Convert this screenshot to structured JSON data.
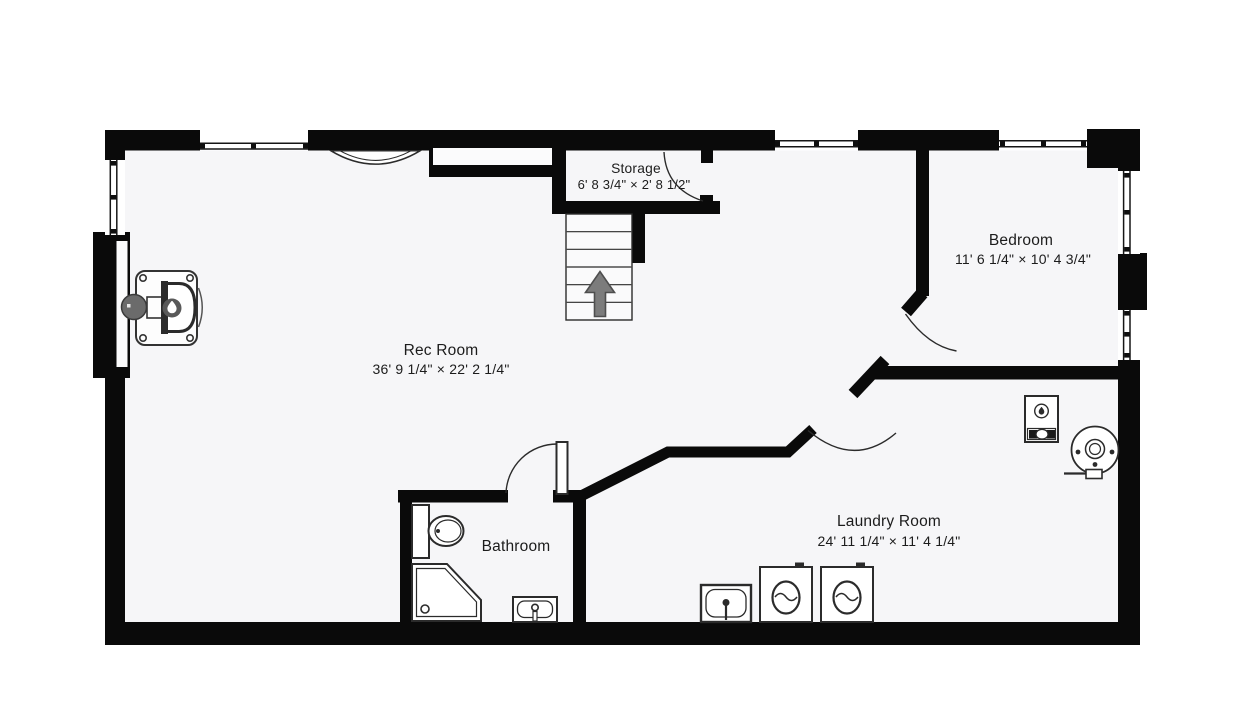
{
  "floorplan": {
    "rooms": [
      {
        "id": "rec-room",
        "name": "Rec Room",
        "dimensions": "36' 9 1/4\" × 22' 2 1/4\""
      },
      {
        "id": "storage",
        "name": "Storage",
        "dimensions": "6' 8 3/4\" × 2' 8 1/2\""
      },
      {
        "id": "bedroom",
        "name": "Bedroom",
        "dimensions": "11' 6 1/4\" × 10' 4 3/4\""
      },
      {
        "id": "bathroom",
        "name": "Bathroom",
        "dimensions": ""
      },
      {
        "id": "laundry-room",
        "name": "Laundry Room",
        "dimensions": "24' 11 1/4\" × 11' 4 1/4\""
      }
    ],
    "fixtures": [
      "wood-stove",
      "chimney",
      "staircase-up",
      "toilet",
      "corner-shower",
      "bathroom-sink",
      "laundry-sink",
      "washer",
      "dryer",
      "furnace",
      "water-heater"
    ],
    "colors": {
      "wall": "#0a0a0a",
      "floor": "#f6f6f8",
      "page": "#ffffff",
      "arrow": "#7c7c7c"
    }
  }
}
